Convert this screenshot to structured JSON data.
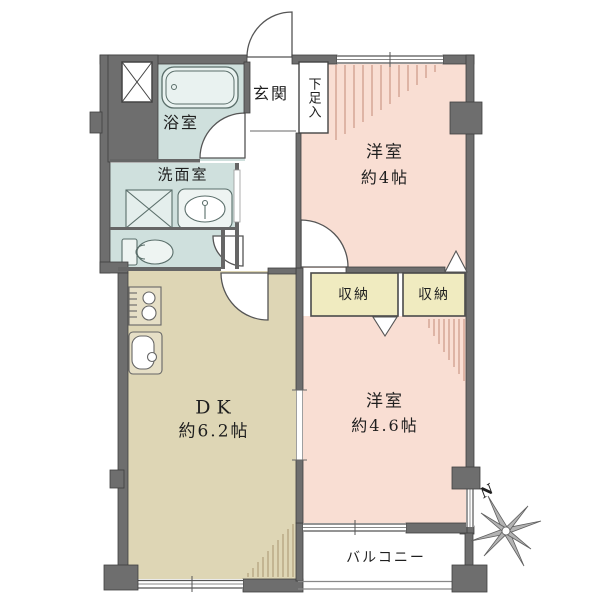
{
  "floorplan": {
    "rooms": {
      "bathroom": {
        "label": "浴室"
      },
      "washroom": {
        "label": "洗面室"
      },
      "genkan": {
        "label": "玄関"
      },
      "shoe_box": {
        "label": "下足入"
      },
      "bedroom1": {
        "label": "洋室",
        "size": "約4帖"
      },
      "closet1": {
        "label": "収納"
      },
      "closet2": {
        "label": "収納"
      },
      "dk": {
        "label": "DK",
        "size": "約6.2帖"
      },
      "bedroom2": {
        "label": "洋室",
        "size": "約4.6帖"
      },
      "balcony": {
        "label": "バルコニー"
      }
    },
    "compass": {
      "north_label": "N"
    },
    "colors": {
      "wall": "#6e6e6e",
      "western_room": "#f9ded3",
      "dining_kitchen": "#ded6b5",
      "wet_area": "#cfe0dd",
      "closet": "#f0ebc0",
      "hatch_warm": "#c28b77",
      "hatch_tan": "#a8946f",
      "fixture_line": "#5a6e6a",
      "text": "#1f1f1f"
    }
  }
}
